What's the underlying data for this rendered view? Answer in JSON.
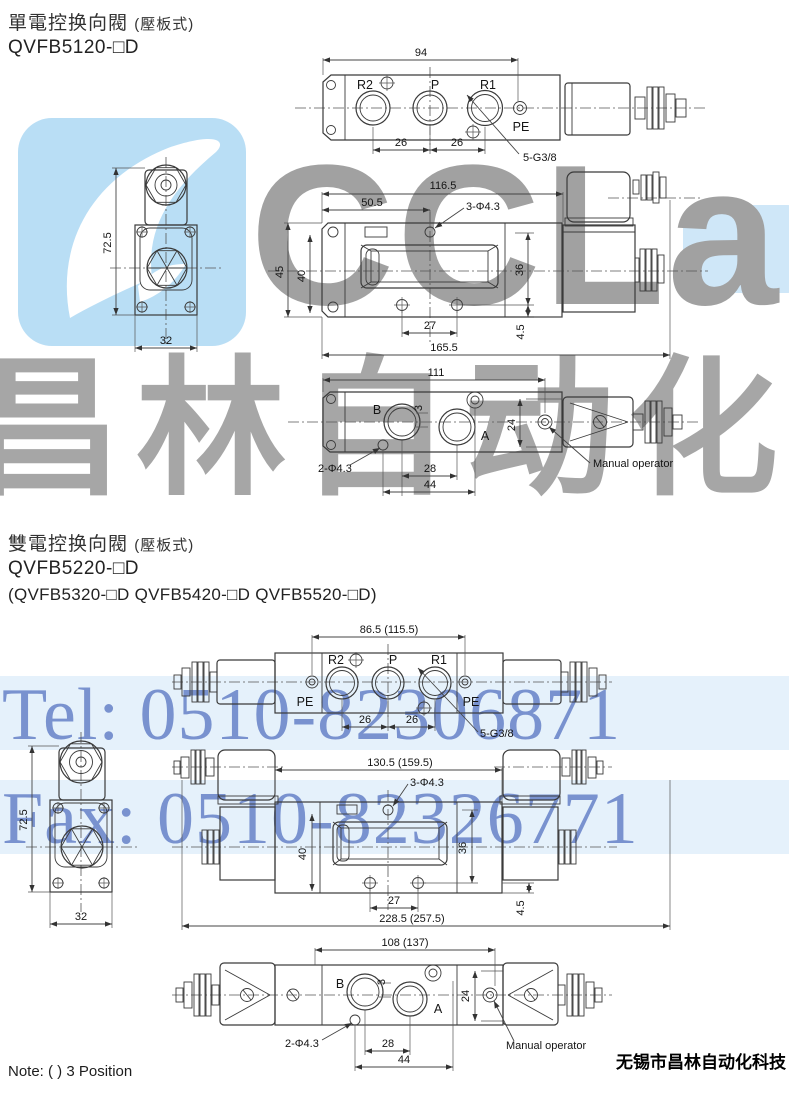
{
  "s1": {
    "heading": "單電控换向閥",
    "heading_paren": "(壓板式)",
    "model": "QVFB5120-□D",
    "top": {
      "d94": "94",
      "r2": "R2",
      "p": "P",
      "r1": "R1",
      "pe": "PE",
      "d26a": "26",
      "d26b": "26",
      "thread": "5-G3/8"
    },
    "end": {
      "d725": "72.5",
      "d32": "32"
    },
    "side": {
      "d1165": "116.5",
      "d505": "50.5",
      "holes": "3-Φ4.3",
      "d45": "45",
      "d40": "40",
      "d36": "36",
      "d27": "27",
      "d45s": "4.5",
      "d1655": "165.5"
    },
    "bot": {
      "d111": "111",
      "b": "B",
      "a": "A",
      "d3": "3",
      "d24": "24",
      "d28": "28",
      "d44": "44",
      "holes": "2-Φ4.3",
      "manual": "Manual operator"
    }
  },
  "s2": {
    "heading": "雙電控换向閥",
    "heading_paren": "(壓板式)",
    "model": "QVFB5220-□D",
    "models_alt": "(QVFB5320-□D  QVFB5420-□D  QVFB5520-□D)",
    "top": {
      "d86": "86.5 (115.5)",
      "r2": "R2",
      "p": "P",
      "r1": "R1",
      "pe1": "PE",
      "pe2": "PE",
      "d26a": "26",
      "d26b": "26",
      "thread": "5-G3/8"
    },
    "end": {
      "d725": "72.5",
      "d32": "32"
    },
    "side": {
      "d130": "130.5 (159.5)",
      "holes": "3-Φ4.3",
      "d40": "40",
      "d36": "36",
      "d27": "27",
      "d45s": "4.5",
      "d228": "228.5 (257.5)"
    },
    "bot": {
      "d108": "108 (137)",
      "b": "B",
      "a": "A",
      "d3": "3",
      "d24": "24",
      "d28": "28",
      "d44": "44",
      "holes": "2-Φ4.3",
      "manual": "Manual operator"
    }
  },
  "footer": {
    "note": "Note: ( ) 3 Position",
    "company": "无锡市昌林自动化科技"
  },
  "watermark": {
    "logo_text": "CCLair",
    "cn": "昌林自动化",
    "tel": "Tel: 0510-82306871",
    "fax": "Fax: 0510-82326771",
    "blue": "#5e7ac4",
    "gray": "#a1a1a1",
    "logo_bg": "#b9def5"
  }
}
